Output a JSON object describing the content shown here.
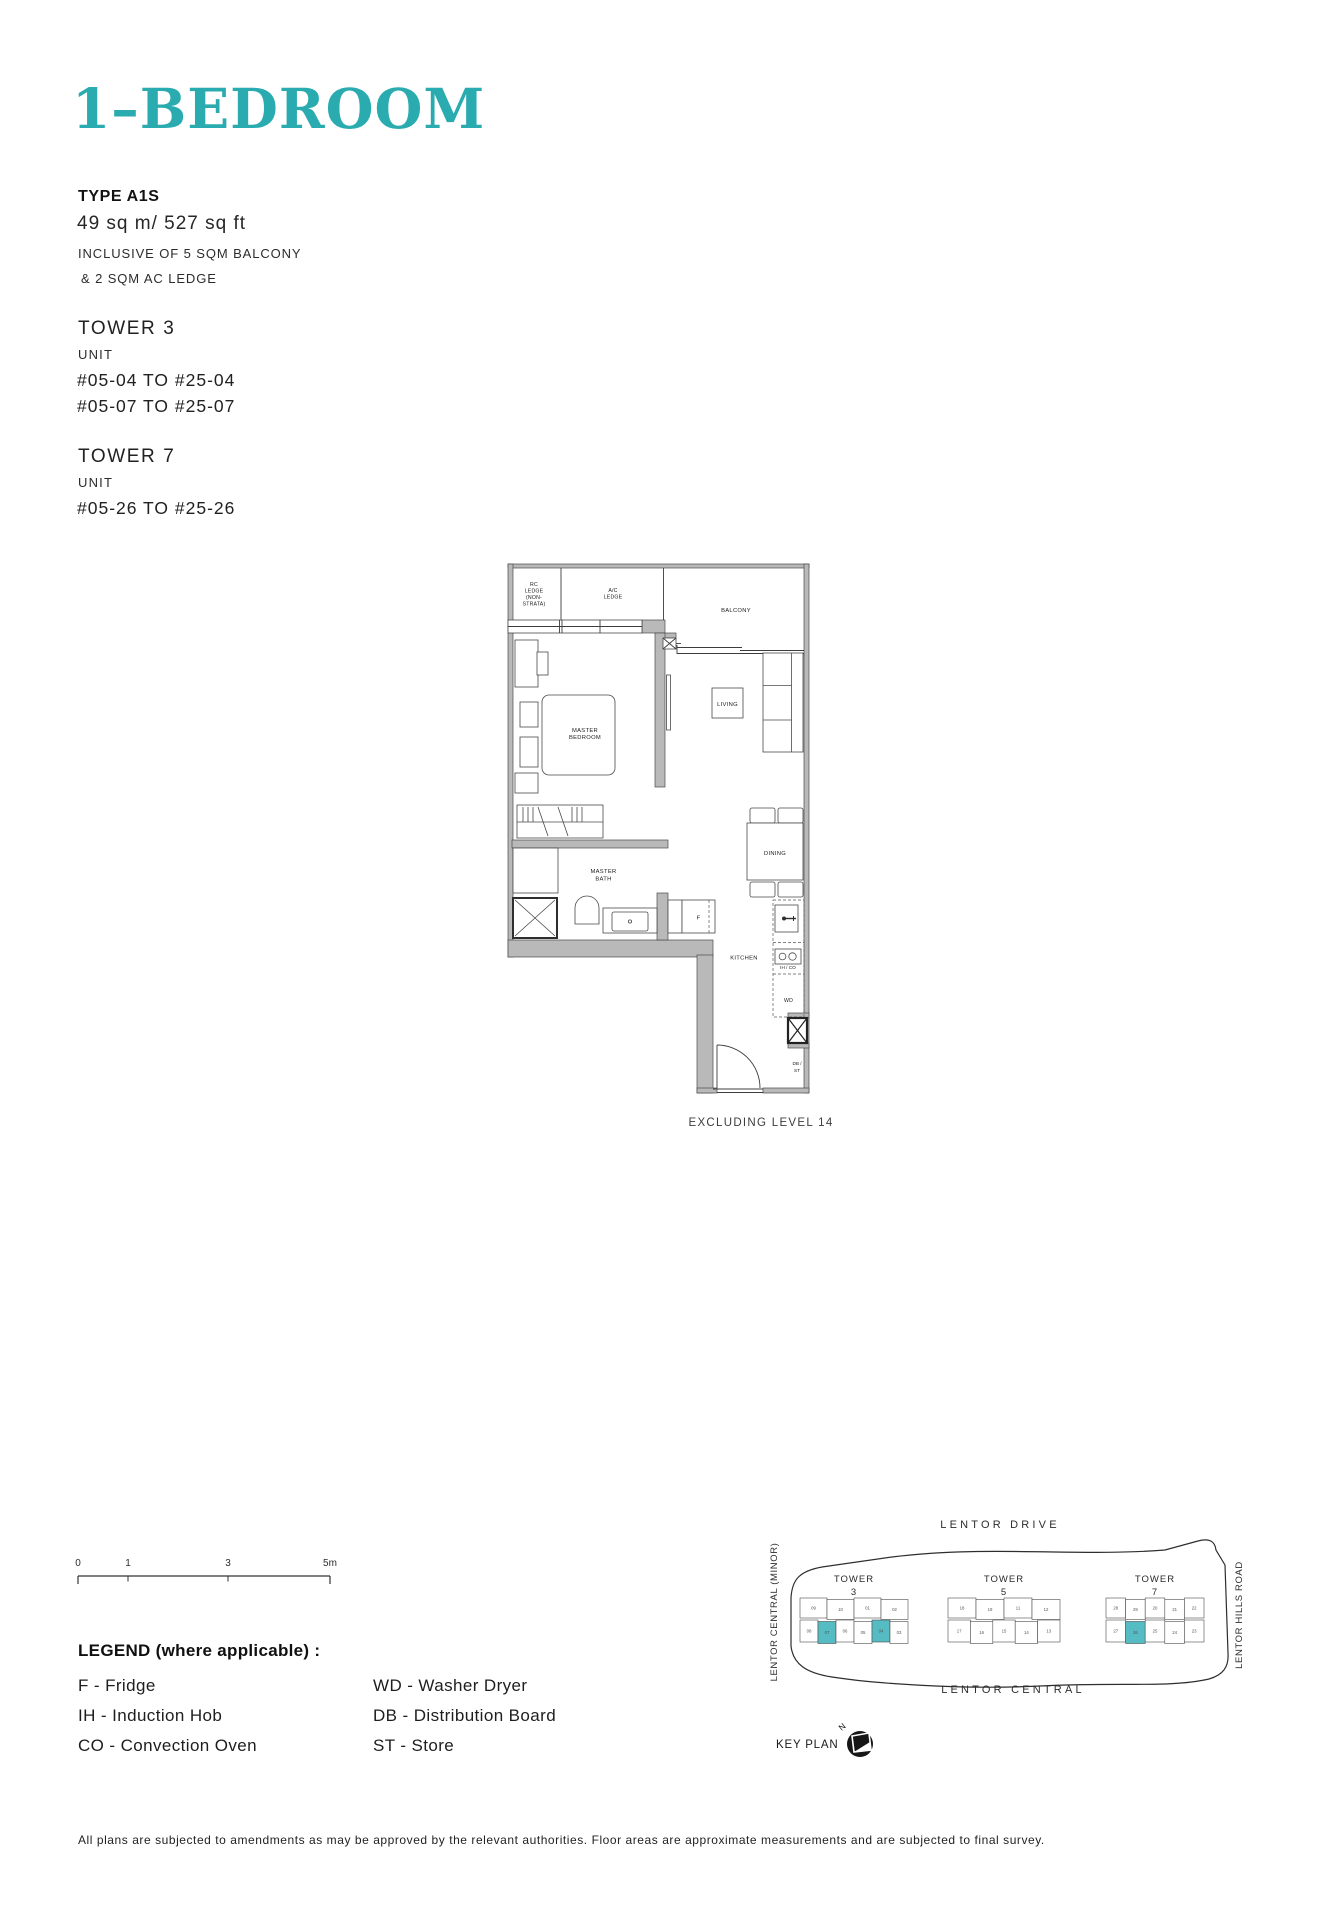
{
  "page": {
    "accent": "#2AABB0",
    "keyplan_highlight": "#56BCC3"
  },
  "info": {
    "title": "1–BEDROOM",
    "type": "TYPE A1S",
    "area": "49 sq m/ 527 sq ft",
    "inclusive1": "INCLUSIVE OF 5 SQM BALCONY",
    "inclusive2": "& 2 SQM AC LEDGE",
    "towers": [
      {
        "name": "TOWER 3",
        "unit_label": "UNIT",
        "lines": [
          "#05-04 TO #25-04",
          "#05-07 TO #25-07"
        ]
      },
      {
        "name": "TOWER 7",
        "unit_label": "UNIT",
        "lines": [
          "#05-26 TO #25-26"
        ]
      }
    ]
  },
  "floorplan": {
    "note": "EXCLUDING LEVEL 14",
    "labels": {
      "rc1": "RC",
      "rc2": "LEDGE",
      "rc3": "(NON-",
      "rc4": "STRATA)",
      "ac1": "A/C",
      "ac2": "LEDGE",
      "balcony": "BALCONY",
      "living": "LIVING",
      "mbr1": "MASTER",
      "mbr2": "BEDROOM",
      "bath1": "MASTER",
      "bath2": "BATH",
      "dining": "DINING",
      "kitchen": "KITCHEN",
      "fridge": "F",
      "hob": "IH / CO",
      "wd": "WD",
      "db": "DB /",
      "st": "ST"
    }
  },
  "scalebar": {
    "ticks": [
      "0",
      "1",
      "3",
      "5m"
    ]
  },
  "legend": {
    "title": "LEGEND (where applicable) :",
    "left": [
      "F - Fridge",
      "IH - Induction Hob",
      "CO - Convection Oven"
    ],
    "right": [
      "WD - Washer Dryer",
      "DB - Distribution Board",
      "ST - Store"
    ]
  },
  "keyplan": {
    "title": "KEY PLAN",
    "north": "N",
    "roads": {
      "top": "LENTOR DRIVE",
      "left": "LENTOR CENTRAL (MINOR)",
      "bottom": "LENTOR CENTRAL",
      "right": "LENTOR HILLS ROAD"
    },
    "towers": [
      {
        "label": "TOWER",
        "number": "3",
        "rows": [
          [
            "09",
            "10",
            "01",
            "02"
          ],
          [
            "08",
            "07",
            "06",
            "05",
            "04",
            "03"
          ]
        ],
        "highlight": [
          "07",
          "04"
        ]
      },
      {
        "label": "TOWER",
        "number": "5",
        "rows": [
          [
            "18",
            "19",
            "11",
            "12"
          ],
          [
            "17",
            "16",
            "15",
            "14",
            "13"
          ]
        ],
        "highlight": []
      },
      {
        "label": "TOWER",
        "number": "7",
        "rows": [
          [
            "28",
            "29",
            "20",
            "21",
            "22"
          ],
          [
            "27",
            "26",
            "25",
            "24",
            "23"
          ]
        ],
        "highlight": [
          "26"
        ]
      }
    ]
  },
  "footer": "All plans are subjected to amendments as may be approved by the relevant authorities. Floor areas are approximate measurements and are subjected to final survey."
}
